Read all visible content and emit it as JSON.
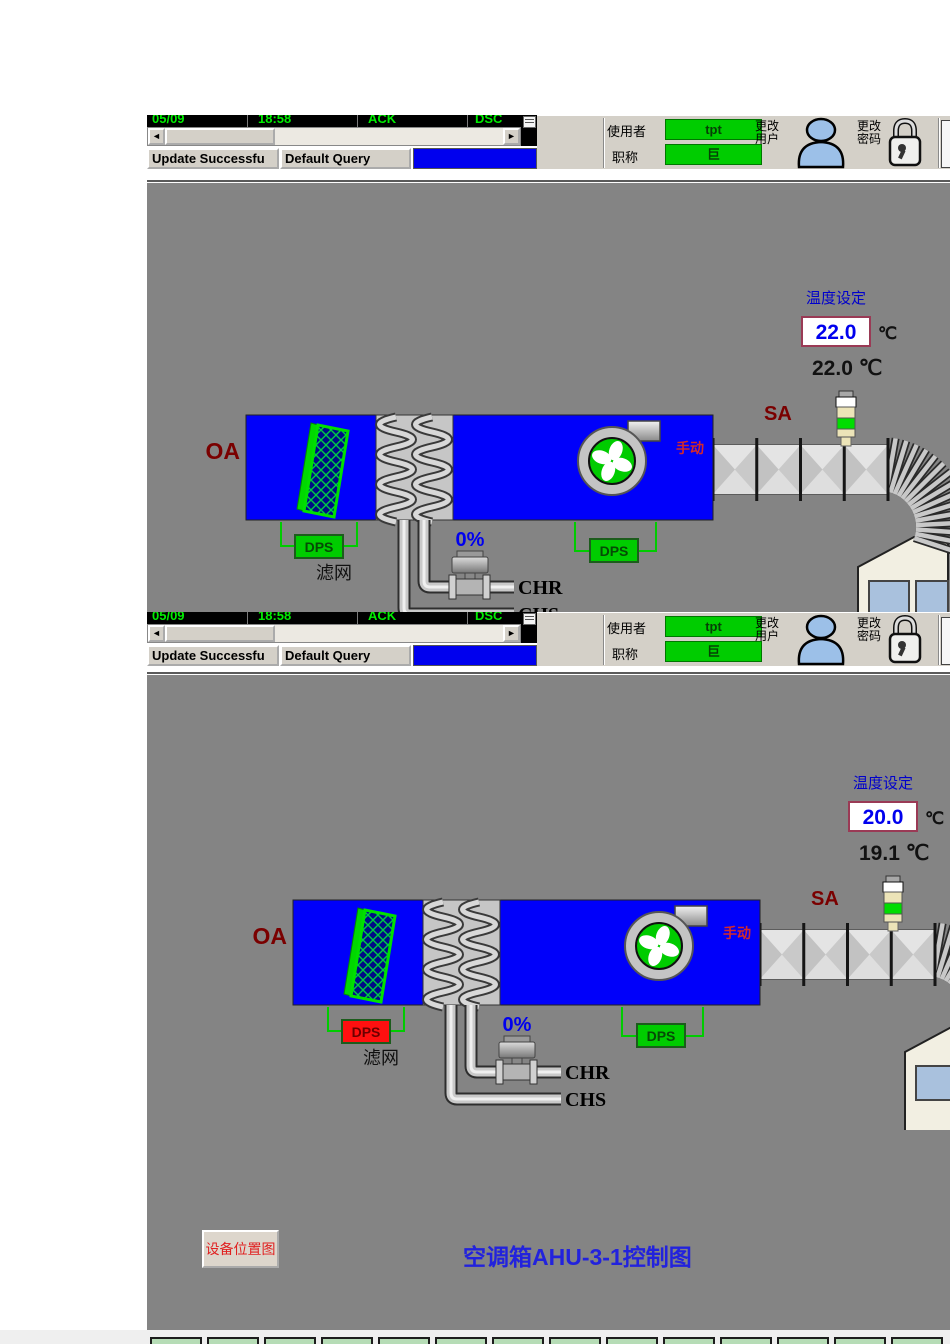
{
  "toolbar": {
    "alarm_cells": [
      "05/09",
      "18:58",
      "ACK",
      "DSC"
    ],
    "update_status": "Update Successfu",
    "query_status": "Default Query",
    "scroll_left": "◄",
    "scroll_right": "►",
    "user_label": "使用者",
    "user_value": "tpt",
    "role_label": "职称",
    "role_value": "巨",
    "change_user_line1": "更改",
    "change_user_line2": "用户",
    "change_pwd_line1": "更改",
    "change_pwd_line2": "密码"
  },
  "panels": [
    {
      "setpoint_label": "温度设定",
      "setpoint_value": "22.0",
      "setpoint_unit": "℃",
      "supply_temp": "22.0 ℃",
      "sa_label": "SA",
      "oa_label": "OA",
      "manual_label": "手动",
      "filter_dps": {
        "label": "DPS",
        "bg": "#00cc00",
        "text": "#064a06"
      },
      "fan_dps": {
        "label": "DPS",
        "bg": "#00cc00",
        "text": "#064a06"
      },
      "filter_label": "滤网",
      "valve_position": "0%",
      "chr_label": "CHR",
      "chs_label": "CHS"
    },
    {
      "setpoint_label": "温度设定",
      "setpoint_value": "20.0",
      "setpoint_unit": "℃",
      "supply_temp": "19.1 ℃",
      "sa_label": "SA",
      "oa_label": "OA",
      "manual_label": "手动",
      "filter_dps": {
        "label": "DPS",
        "bg": "#ff1010",
        "text": "#6b0000"
      },
      "fan_dps": {
        "label": "DPS",
        "bg": "#00cc00",
        "text": "#064a06"
      },
      "filter_label": "滤网",
      "valve_position": "0%",
      "chr_label": "CHR",
      "chs_label": "CHS"
    }
  ],
  "footer": {
    "location_button": "设备位置图",
    "title": "空调箱AHU-3-1控制图",
    "bottom_button_count": 14
  },
  "colors": {
    "ahu_blue": "#0000fa",
    "canvas_gray": "#848484",
    "alarm_green": "#00ee00",
    "alarm_red": "#ff1010"
  }
}
